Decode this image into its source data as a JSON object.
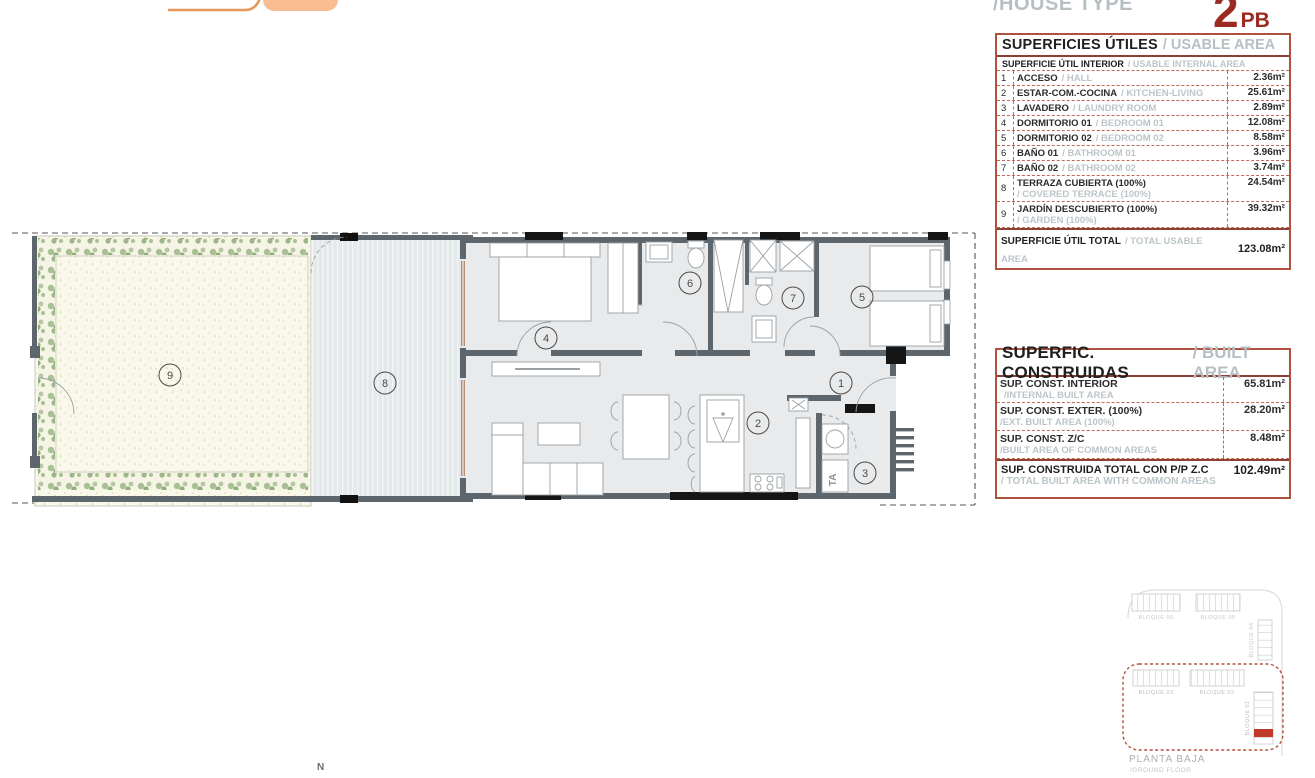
{
  "header": {
    "house_type_label": "/HOUSE TYPE",
    "type_number": "2",
    "type_suffix": "PB"
  },
  "usable_table": {
    "title_es": "SUPERFICIES ÚTILES",
    "title_en": "/ USABLE AREA",
    "subheader_es": "SUPERFICIE ÚTIL INTERIOR",
    "subheader_en": "/ USABLE INTERNAL AREA",
    "rows": [
      {
        "num": "1",
        "es": "ACCESO",
        "en": "/ HALL",
        "value": "2.36m²"
      },
      {
        "num": "2",
        "es": "ESTAR-COM.-COCINA",
        "en": "/ KITCHEN-LIVING",
        "value": "25.61m²"
      },
      {
        "num": "3",
        "es": "LAVADERO",
        "en": "/ LAUNDRY ROOM",
        "value": "2.89m²"
      },
      {
        "num": "4",
        "es": "DORMITORIO 01",
        "en": "/ BEDROOM 01",
        "value": "12.08m²"
      },
      {
        "num": "5",
        "es": "DORMITORIO 02",
        "en": "/ BEDROOM 02",
        "value": "8.58m²"
      },
      {
        "num": "6",
        "es": "BAÑO 01",
        "en": "/ BATHROOM 01",
        "value": "3.96m²"
      },
      {
        "num": "7",
        "es": "BAÑO 02",
        "en": "/ BATHROOM 02",
        "value": "3.74m²"
      },
      {
        "num": "8",
        "es": "TERRAZA CUBIERTA (100%)",
        "en": "/ COVERED TERRACE (100%)",
        "value": "24.54m²"
      },
      {
        "num": "9",
        "es": "JARDÍN DESCUBIERTO (100%)",
        "en": "/ GARDEN (100%)",
        "value": "39.32m²"
      }
    ],
    "total_es": "SUPERFICIE ÚTIL TOTAL",
    "total_en": "/ TOTAL USABLE AREA",
    "total_value": "123.08m²"
  },
  "built_table": {
    "title_es": "SUPERFIC. CONSTRUIDAS",
    "title_en": "/ BUILT AREA",
    "rows": [
      {
        "es": "SUP. CONST. INTERIOR",
        "en": "/INTERNAL BUILT AREA",
        "value": "65.81m²"
      },
      {
        "es": "SUP. CONST. EXTER. (100%)",
        "en": "/EXT. BUILT AREA (100%)",
        "value": "28.20m²"
      },
      {
        "es": "SUP. CONST. Z/C",
        "en": "/BUILT AREA OF COMMON AREAS",
        "value": "8.48m²"
      }
    ],
    "total_es": "SUP. CONSTRUIDA TOTAL CON P/P Z.C",
    "total_en": "/ TOTAL BUILT AREA WITH COMMON AREAS",
    "total_value": "102.49m²"
  },
  "plan": {
    "room_labels": [
      "1",
      "2",
      "3",
      "4",
      "5",
      "6",
      "7",
      "8",
      "9"
    ],
    "washer_label": "TA",
    "north_label": "N"
  },
  "site_plan": {
    "block_06": "BLOQUE 06",
    "block_05": "BLOQUE 05",
    "block_04": "BLOQUE 04",
    "block_03": "BLOQUE 03",
    "block_02": "BLOQUE 02",
    "block_01": "BLOQUE 01",
    "floor_es": "PLANTA BAJA",
    "floor_en": "/GROUND FLOOR"
  },
  "colors": {
    "table_border": "#b0503f",
    "type_red": "#9b2a20",
    "gray_text": "#b7bfc3",
    "wall": "#5d666d",
    "floor": "#e9eaeb",
    "garden": "#faf8ea",
    "plants": "#a9c095",
    "terrace": "#e2e7ea",
    "logo_fill": "#f9bd92",
    "logo_line": "#e8985c",
    "unit_highlight": "#c0392b"
  }
}
